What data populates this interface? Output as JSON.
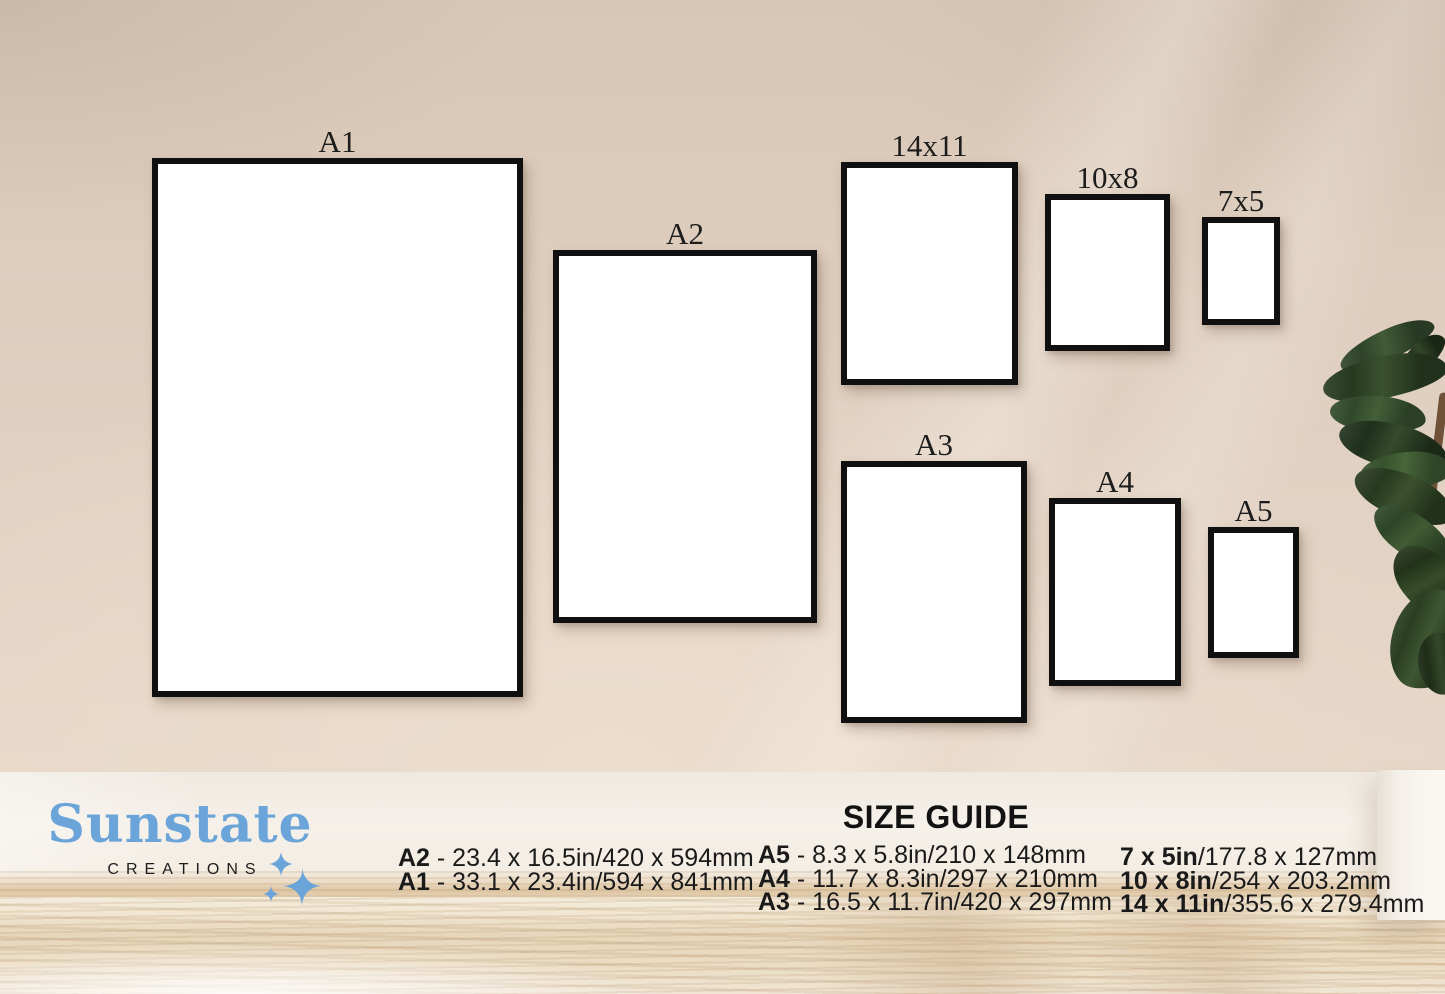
{
  "brand": {
    "name": "Sunstate",
    "subtitle": "CREATIONS",
    "accent_color": "#6ba4d8"
  },
  "colors": {
    "wall": "#e0d0c2",
    "frame_border": "#101010",
    "floor": "#e8d8bd"
  },
  "frames": [
    {
      "label": "A1"
    },
    {
      "label": "A2"
    },
    {
      "label": "14x11"
    },
    {
      "label": "10x8"
    },
    {
      "label": "7x5"
    },
    {
      "label": "A3"
    },
    {
      "label": "A4"
    },
    {
      "label": "A5"
    }
  ],
  "size_guide": {
    "title": "SIZE GUIDE",
    "columns": [
      {
        "rows": [
          {
            "label": "A2",
            "detail": " - 23.4 x 16.5in/420 x 594mm"
          },
          {
            "label": "A1",
            "detail": " - 33.1 x 23.4in/594 x 841mm"
          }
        ]
      },
      {
        "rows": [
          {
            "label": "A5",
            "detail": " - 8.3 x 5.8in/210 x 148mm"
          },
          {
            "label": "A4",
            "detail": " - 11.7 x 8.3in/297 x 210mm"
          },
          {
            "label": "A3",
            "detail": " - 16.5 x 11.7in/420 x 297mm"
          }
        ]
      },
      {
        "rows": [
          {
            "label": "7 x 5in",
            "detail": "/177.8 x 127mm"
          },
          {
            "label": "10 x 8in",
            "detail": "/254 x 203.2mm"
          },
          {
            "label": "14 x 11in",
            "detail": "/355.6 x 279.4mm"
          }
        ]
      }
    ]
  }
}
